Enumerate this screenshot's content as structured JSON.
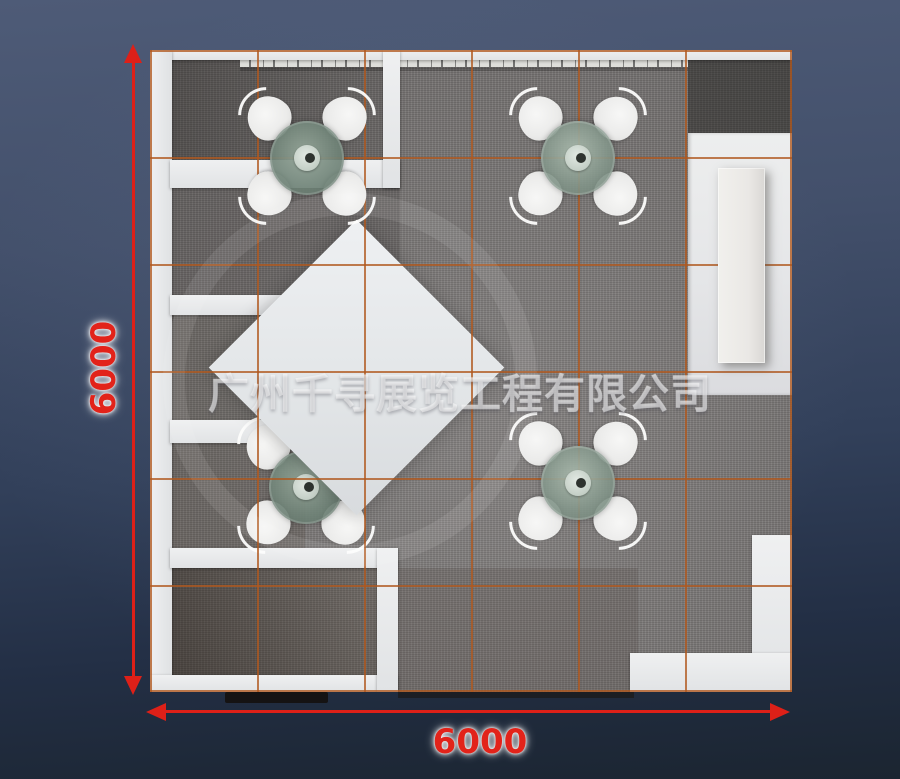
{
  "watermark": {
    "text": "广州千寻展览工程有限公司"
  },
  "dimensions": {
    "height": {
      "label": "6000"
    },
    "width": {
      "label": "6000"
    }
  },
  "palette": {
    "dimension_red": "#e2231a",
    "grid_orange": "#b0581e",
    "carpet_gray": "#7b7877",
    "wall_white": "#e9eaeb",
    "table_glass_green": "#8da092",
    "background_top": "#4e5b77",
    "background_bottom": "#1b2531"
  },
  "icons": {
    "dimension_arrows": "red-triangle-arrowheads",
    "watermark_ring": "faint-circle-stamp"
  }
}
